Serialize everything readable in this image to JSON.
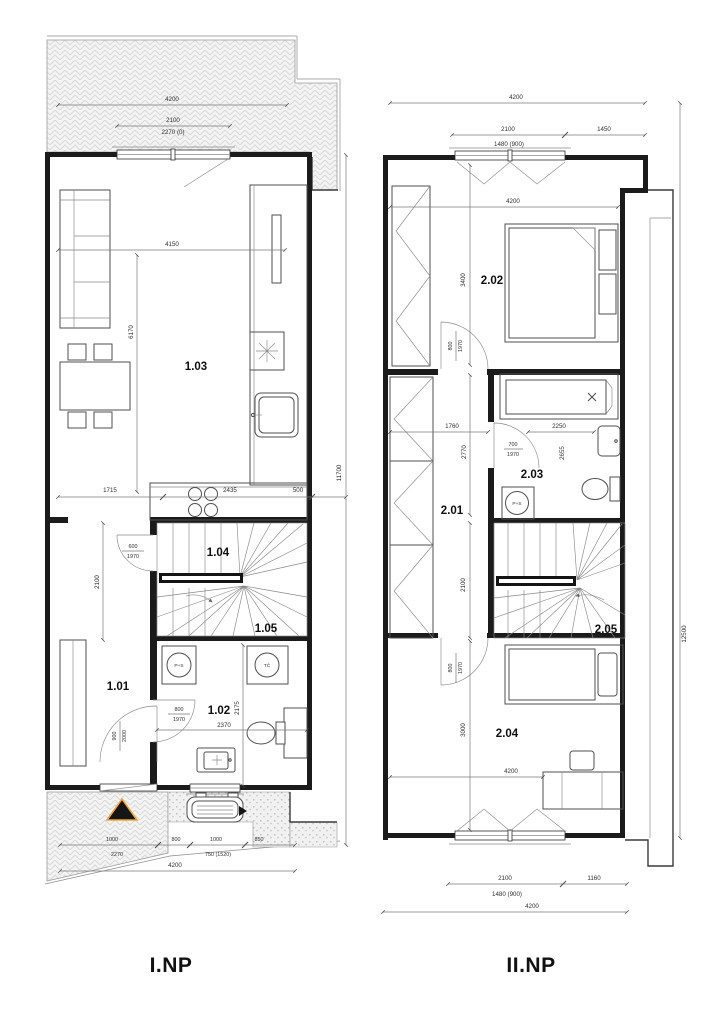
{
  "page": {
    "background": "#ffffff"
  },
  "colors": {
    "wall": "#1b1b1b",
    "dimension": "#7a7a7a",
    "hatch": "#d6d6d6",
    "triangle_fill": "#151515",
    "triangle_border": "#f0a13a"
  },
  "floor1": {
    "label": "I.NP",
    "rooms": {
      "r101": "1.01",
      "r102": "1.02",
      "r103": "1.03",
      "r104": "1.04",
      "r105": "1.05"
    },
    "symbols": {
      "washer": "P+S",
      "heat_pump": "TČ"
    },
    "dims": {
      "top_total": "4200",
      "top_opening": "2100",
      "top_opening_alt": "2270 (0)",
      "living_width": "4150",
      "living_height": "6170",
      "kitchen_left": "1715",
      "kitchen_run": "2435",
      "kitchen_depth": "500",
      "stair_door_w": "600",
      "stair_door_h": "1970",
      "hall_height": "2100",
      "bath_door_w": "800",
      "bath_door_h": "1970",
      "bath_width": "2370",
      "bath_height": "2175",
      "entry_door_w": "900",
      "entry_door_h": "2000",
      "walk_a": "1000",
      "walk_a_alt": "2270",
      "walk_b": "800",
      "walk_c": "1000",
      "walk_c_alt": "750 (1520)",
      "walk_d": "850",
      "bottom_total": "4200",
      "right_total": "11700"
    }
  },
  "floor2": {
    "label": "II.NP",
    "rooms": {
      "r201": "2.01",
      "r202": "2.02",
      "r203": "2.03",
      "r204": "2.04",
      "r205": "2.05"
    },
    "symbols": {
      "washer": "P+S"
    },
    "dims": {
      "top_total": "4200",
      "top_opening": "2100",
      "top_opening_alt": "1480 (900)",
      "top_right": "1450",
      "room202_width": "4200",
      "room202_height": "3400",
      "door202_w": "800",
      "door202_h": "1970",
      "hall_width": "1760",
      "hall_height": "2770",
      "bath_door_w": "700",
      "bath_door_h": "1970",
      "bath_width": "2250",
      "bath_height": "2655",
      "stair_height": "2100",
      "door204_w": "800",
      "door204_h": "1970",
      "room204_height": "3000",
      "room204_width": "4200",
      "bottom_opening": "2100",
      "bottom_opening_alt": "1480 (900)",
      "bottom_right": "1160",
      "bottom_total": "4200",
      "right_total": "12500"
    }
  }
}
